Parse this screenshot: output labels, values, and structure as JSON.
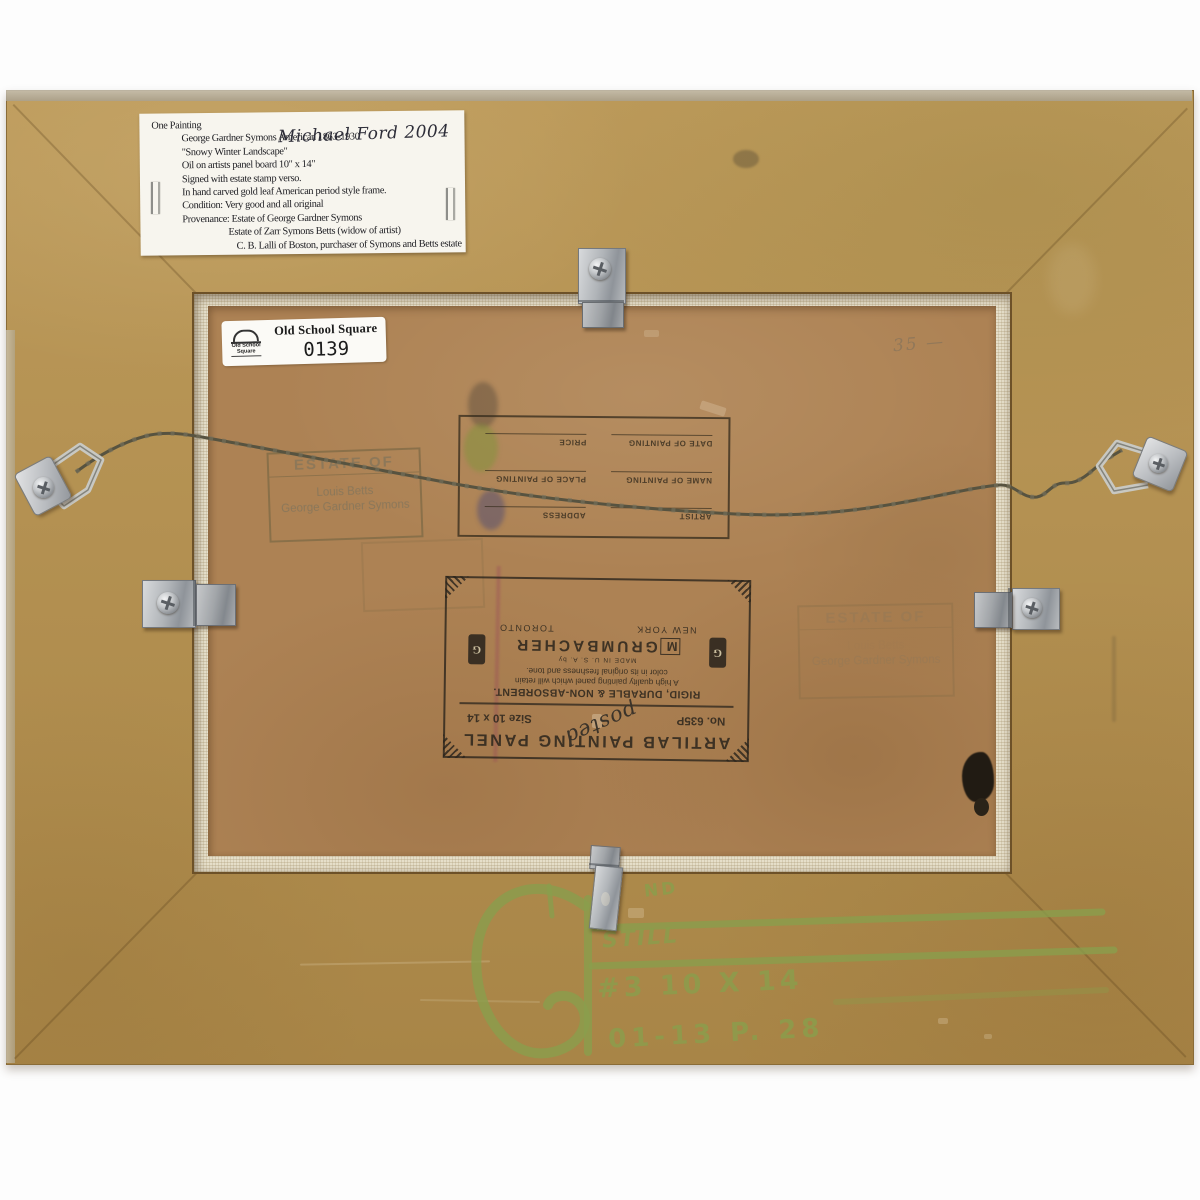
{
  "photo": {
    "subject": "verso of a framed oil painting",
    "background": "#fdfdfd",
    "colors": {
      "frame_gold": "#b5914f",
      "panel_tan": "#ad8254",
      "canvas_edge": "#e6dfca",
      "label_white": "#f7f5ee",
      "stamp_ink": "#8a775a",
      "print_ink": "#2e2921",
      "crayon_green": "#8a9e4c",
      "hardware_silver": "#b9bcc0"
    }
  },
  "typed_label": {
    "heading": "One Painting",
    "handwritten_note": "Michael Ford 2004",
    "lines": [
      "George Gardner Symons      American 1863-1930",
      "\"Snowy Winter Landscape\"",
      "Oil on artists panel board  10\" x 14\"",
      "Signed with estate stamp verso.",
      "In hand carved gold leaf American period style frame.",
      "Condition: Very good and all original",
      "Provenance: Estate of George Gardner Symons",
      "Estate of Zarr Symons Betts (widow of artist)",
      "C. B. Lalli of Boston, purchaser of Symons and Betts estate"
    ]
  },
  "inventory_sticker": {
    "logo_caption": "Old School Square",
    "title": "Old School Square",
    "number": "0139"
  },
  "estate_stamp": {
    "title": "ESTATE OF",
    "name1": "Louis Betts",
    "name2": "George Gardner Symons"
  },
  "artist_form": {
    "fields": [
      "ARTIST",
      "ADDRESS",
      "NAME OF PAINTING",
      "PLACE OF PAINTING",
      "DATE OF PAINTING",
      "PRICE"
    ]
  },
  "panel_label": {
    "title": "ARTILAB PAINTING PANEL",
    "stock_no": "No. 635P",
    "size": "Size 10 x 14",
    "scribble": "posted",
    "tagline": "RIGID, DURABLE & NON-ABSORBENT.",
    "desc_line1": "A high quality painting panel which will retain",
    "desc_line2": "color in its original freshness and tone.",
    "made_in": "MADE IN U. S. A. by",
    "brand_logo_letter": "M",
    "brand_name": "GRUMBACHER",
    "city_left": "NEW YORK",
    "city_right": "TORONTO",
    "badge_letter": "G"
  },
  "pencil_note": "35 —",
  "crayon_notes": {
    "small_caps": "ND",
    "word": "STILL",
    "size_line": "#3 10 X 14",
    "ref_line": "01-13 P. 28"
  }
}
